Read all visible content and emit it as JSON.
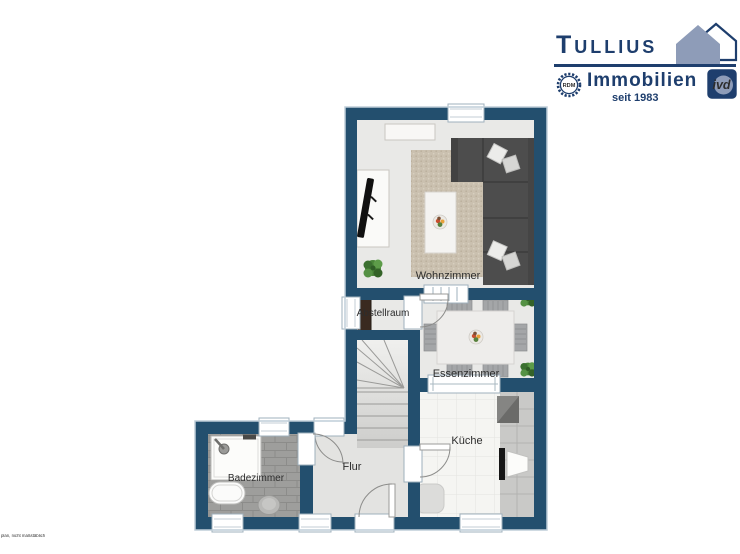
{
  "branding": {
    "name": "Tullius",
    "division": "Immobilien",
    "tagline": "seit 1983",
    "seal_rdm": "RDM",
    "seal_ivd": "ivd",
    "colors": {
      "navy": "#1e3e6d",
      "house_gray": "#8e9cb8"
    }
  },
  "floorplan": {
    "rooms": [
      {
        "name": "wohnzimmer",
        "label": "Wohnzimmer"
      },
      {
        "name": "abstellraum",
        "label": "Abstellraum"
      },
      {
        "name": "essenzimmer",
        "label": "Essenzimmer"
      },
      {
        "name": "kueche",
        "label": "Küche"
      },
      {
        "name": "flur",
        "label": "Flur"
      },
      {
        "name": "badezimmer",
        "label": "Badezimmer"
      }
    ],
    "note": "plan, nicht maßstäblich",
    "colors": {
      "wall": "#234f6e",
      "floor": "#e9e9e7",
      "bath_tile": "#9e9e9c",
      "kitchen_tile": "#f5f5f2",
      "rug": "#cac0af",
      "sofa": "#4d4d4d",
      "counter": "#c9c9c7",
      "stairs": "#e4e4e2",
      "plant_green": "#4a8539"
    }
  }
}
